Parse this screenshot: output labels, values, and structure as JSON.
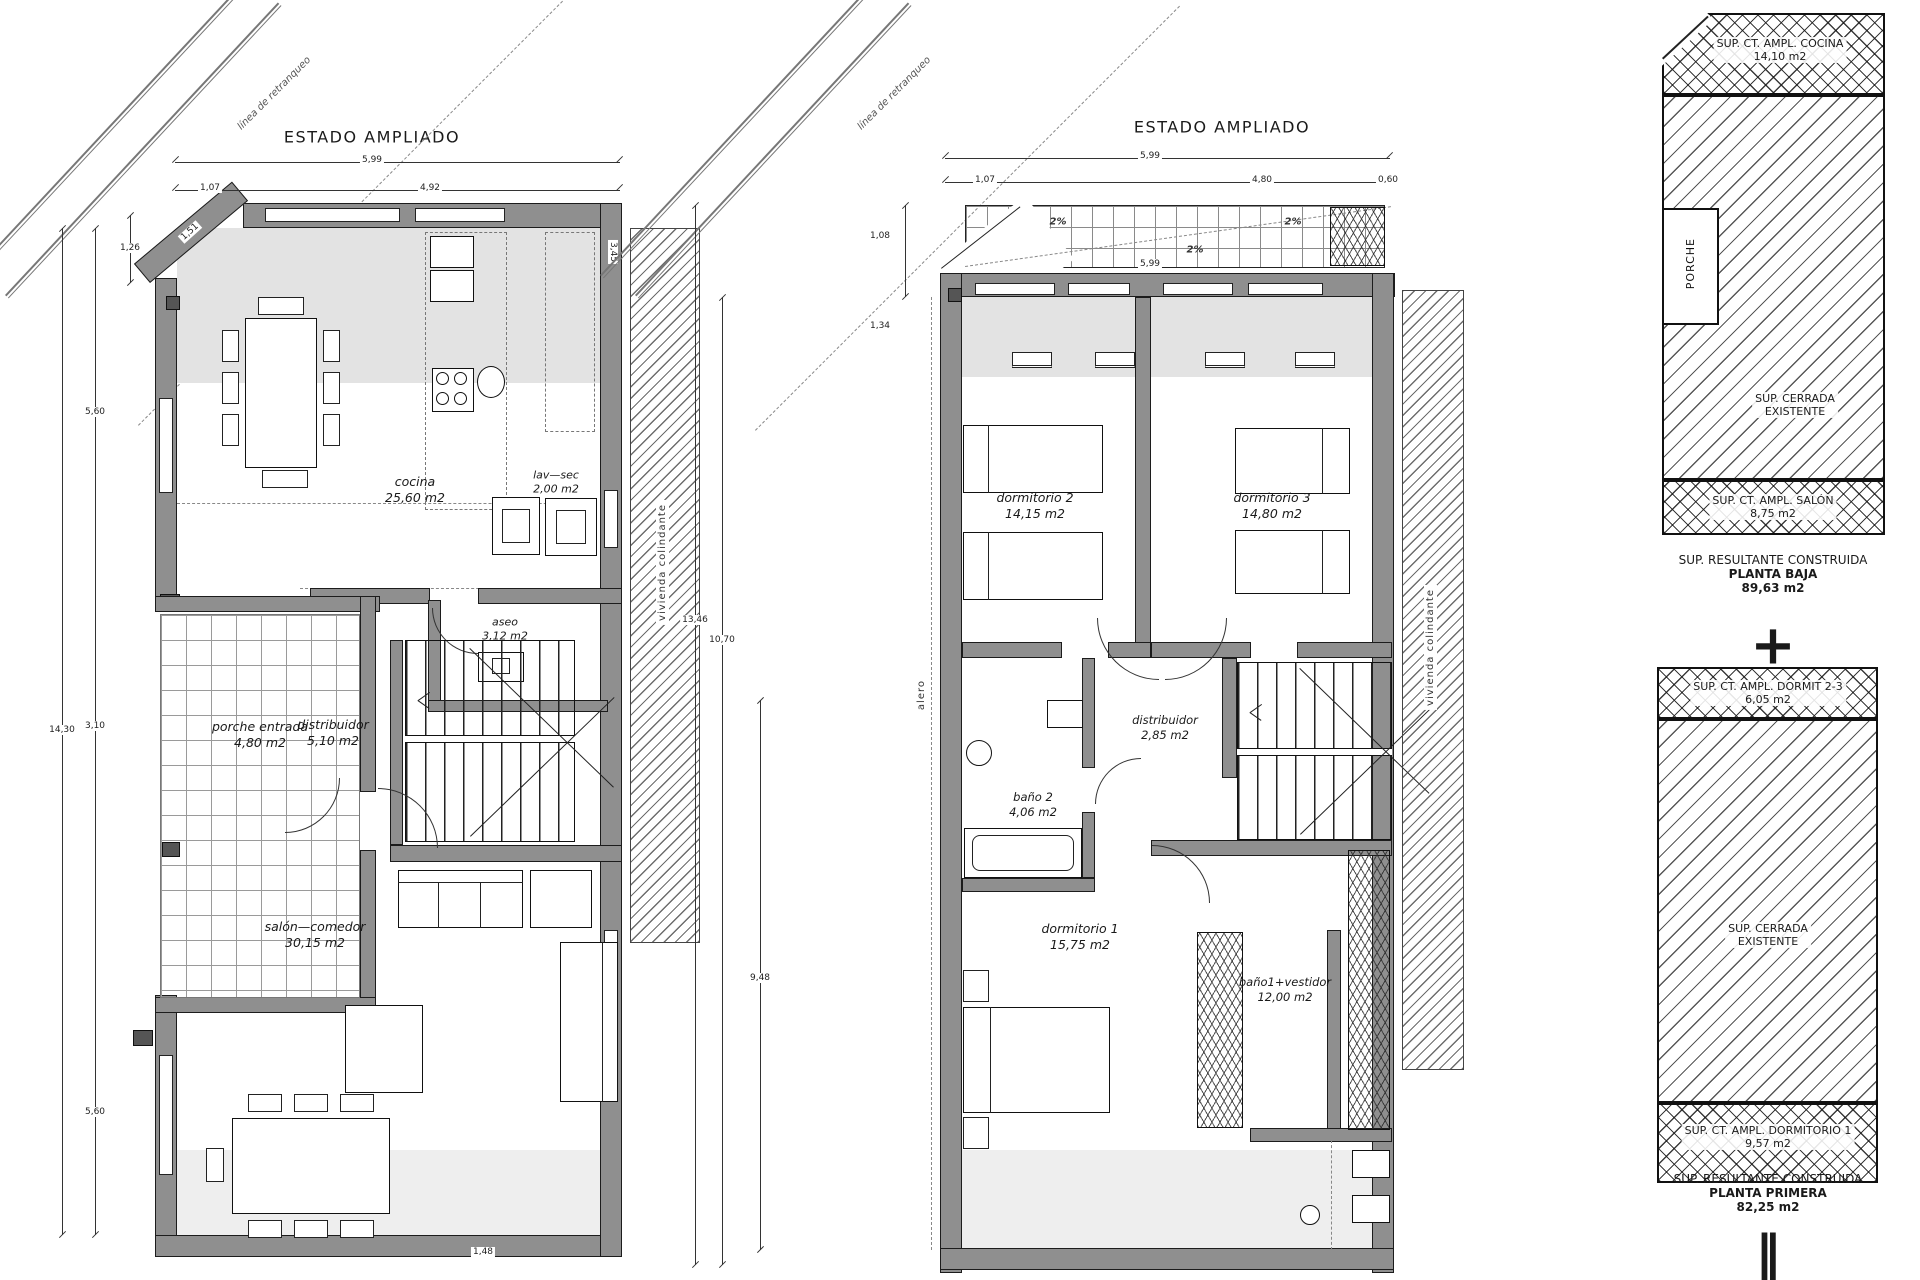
{
  "plan_ground": {
    "title": "ESTADO AMPLIADO",
    "boundary_label": "línea de retranqueo",
    "party_wall_label": "vivienda colindante",
    "rooms": {
      "cocina": {
        "name": "cocina",
        "area": "25,60 m2"
      },
      "lavsec": {
        "name": "lav—sec",
        "area": "2,00 m2"
      },
      "aseo": {
        "name": "aseo",
        "area": "3,12 m2"
      },
      "porche": {
        "name": "porche entrada",
        "area": "4,80 m2"
      },
      "distribuidor": {
        "name": "distribuidor",
        "area": "5,10 m2"
      },
      "salon": {
        "name": "salón—comedor",
        "area": "30,15 m2"
      }
    },
    "dims": {
      "top_total": "5,99",
      "top_a": "1,07",
      "top_b": "4,92",
      "diagonal": "1,51",
      "left_top": "1,26",
      "left_a": "5,60",
      "left_total": "14,30",
      "left_b": "3,10",
      "left_c": "5,60",
      "right_side": "3,45",
      "bottom": "1,48"
    }
  },
  "plan_first": {
    "title": "ESTADO AMPLIADO",
    "boundary_label": "línea de retranqueo",
    "party_wall_label": "vivienda colindante",
    "eave_label": "alero",
    "slopes": {
      "s1": "2%",
      "s2": "2%",
      "s3": "2%"
    },
    "rooms": {
      "dorm2": {
        "name": "dormitorio 2",
        "area": "14,15 m2"
      },
      "dorm3": {
        "name": "dormitorio 3",
        "area": "14,80 m2"
      },
      "distribuidor": {
        "name": "distribuidor",
        "area": "2,85 m2"
      },
      "bano2": {
        "name": "baño 2",
        "area": "4,06 m2"
      },
      "dorm1": {
        "name": "dormitorio 1",
        "area": "15,75 m2"
      },
      "bano1": {
        "name": "baño1+vestidor",
        "area": "12,00 m2"
      }
    },
    "dims": {
      "top_total": "5,99",
      "top_a": "1,07",
      "top_b": "4,80",
      "top_c": "0,60",
      "inner": "5,99",
      "left_a": "1,08",
      "left_b": "1,34",
      "left_total": "13,46",
      "left_inner": "10,70",
      "left_c": "9,48"
    }
  },
  "summary_baja": {
    "block_top": {
      "line1": "SUP. CT. AMPL. COCINA",
      "line2": "14,10 m2"
    },
    "porch_label": "PORCHE",
    "block_mid": {
      "line1": "SUP. CERRADA",
      "line2": "EXISTENTE"
    },
    "block_bottom": {
      "line1": "SUP. CT. AMPL. SALÓN",
      "line2": "8,75 m2"
    },
    "caption": {
      "line1": "SUP. RESULTANTE CONSTRUIDA",
      "line2": "PLANTA BAJA",
      "line3": "89,63 m2"
    },
    "operator": "+"
  },
  "summary_primera": {
    "block_top": {
      "line1": "SUP. CT. AMPL. DORMIT 2-3",
      "line2": "6,05 m2"
    },
    "block_mid": {
      "line1": "SUP. CERRADA",
      "line2": "EXISTENTE"
    },
    "block_bottom": {
      "line1": "SUP. CT. AMPL. DORMITORIO 1",
      "line2": "9,57 m2"
    },
    "caption": {
      "line1": "SUP. RESULTANTE CONSTRUIDA",
      "line2": "PLANTA PRIMERA",
      "line3": "82,25 m2"
    },
    "operator": "‖"
  }
}
